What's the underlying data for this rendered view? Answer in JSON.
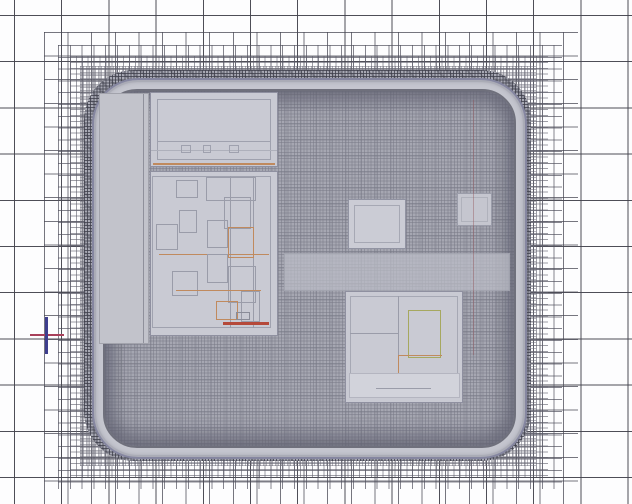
{
  "view": {
    "description": "Adaptive mesh view of chip package",
    "canvas": {
      "width": 632,
      "height": 504
    },
    "background": "#fdfdfe"
  },
  "colors": {
    "coarse_grid_line": "#44444e",
    "package_band": "#c5c6cf",
    "package_edge": "#8586a0",
    "die_mesh_base": "#a6a7b2",
    "block_fill": "#c9cad3",
    "block_border": "#8f90a0",
    "accent_orange": "#c08a5e",
    "accent_red": "#b5493a",
    "accent_green": "#a6a85f",
    "marker_red": "#a8405a",
    "marker_navy": "#3e3e8e"
  },
  "grid": {
    "coarse_cell_px": 47,
    "zones": [
      {
        "name": "refine-24px",
        "x": 44,
        "y": 32,
        "w": 534,
        "h": 472,
        "cell": 23.6,
        "line": "rgba(72,72,84,0.75)"
      },
      {
        "name": "refine-12px",
        "x": 58,
        "y": 45,
        "w": 504,
        "h": 444,
        "cell": 11.8,
        "line": "rgba(82,82,95,0.7)"
      },
      {
        "name": "refine-6px",
        "x": 70,
        "y": 56,
        "w": 478,
        "h": 421,
        "cell": 5.9,
        "line": "rgba(94,94,107,0.6)"
      },
      {
        "name": "refine-3px",
        "x": 80,
        "y": 66,
        "w": 456,
        "h": 400,
        "cell": 3.0,
        "line": "rgba(110,110,122,0.5)"
      }
    ]
  },
  "package": {
    "halo": {
      "x": 84,
      "y": 70,
      "w": 447,
      "h": 391
    },
    "body": {
      "x": 92,
      "y": 78,
      "w": 431,
      "h": 377
    },
    "interior": {
      "x": 103,
      "y": 89,
      "w": 409,
      "h": 355
    }
  },
  "blocks": [
    {
      "id": "left-margin-strip",
      "x": 99,
      "y": 93,
      "w": 50,
      "h": 251,
      "fill": "#c2c3cb",
      "border": "rgba(140,141,152,0.6)",
      "textured": true,
      "inner": [
        {
          "x": 43,
          "y": 0,
          "w": 1,
          "h": 249,
          "fill": "#8f909b"
        }
      ]
    },
    {
      "id": "top-block",
      "x": 150,
      "y": 92,
      "w": 128,
      "h": 75,
      "fill": "#c9cad3",
      "border": "#8f90a0",
      "textured": true,
      "inner": [
        {
          "x": 6,
          "y": 6,
          "w": 114,
          "h": 61,
          "stroke": "#9fa1ae"
        },
        {
          "x": 6,
          "y": 48,
          "w": 114,
          "h": 1,
          "fill": "#9fa1ae"
        },
        {
          "x": 0,
          "y": 57,
          "w": 126,
          "h": 1,
          "fill": "#aeb0bb"
        },
        {
          "x": 30,
          "y": 52,
          "w": 10,
          "h": 8,
          "stroke": "#9fa1ae"
        },
        {
          "x": 52,
          "y": 52,
          "w": 8,
          "h": 8,
          "stroke": "#9fa1ae"
        },
        {
          "x": 78,
          "y": 52,
          "w": 10,
          "h": 8,
          "stroke": "#9fa1ae"
        },
        {
          "x": 2,
          "y": 70,
          "w": 122,
          "h": 2,
          "fill": "#c08a5e"
        }
      ]
    },
    {
      "id": "left-tall-block",
      "x": 150,
      "y": 171,
      "w": 128,
      "h": 165,
      "fill": "#c9cad3",
      "border": "#8f90a0",
      "textured": true,
      "inner": [
        {
          "x": 1,
          "y": 4,
          "w": 119,
          "h": 152,
          "stroke": "#a0a2af"
        },
        {
          "x": 79,
          "y": 4,
          "w": 1,
          "h": 152,
          "fill": "#9a9ca9"
        },
        {
          "x": 102,
          "y": 4,
          "w": 1,
          "h": 152,
          "fill": "#9a9ca9"
        },
        {
          "x": 25,
          "y": 8,
          "w": 22,
          "h": 18,
          "stroke": "#9a9ca9"
        },
        {
          "x": 55,
          "y": 5,
          "w": 50,
          "h": 24,
          "stroke": "#9a9ca9"
        },
        {
          "x": 73,
          "y": 25,
          "w": 27,
          "h": 32,
          "stroke": "#9a9ca9"
        },
        {
          "x": 28,
          "y": 38,
          "w": 18,
          "h": 23,
          "stroke": "#9a9ca9"
        },
        {
          "x": 5,
          "y": 52,
          "w": 22,
          "h": 26,
          "stroke": "#9a9ca9"
        },
        {
          "x": 56,
          "y": 48,
          "w": 21,
          "h": 28,
          "stroke": "#9a9ca9"
        },
        {
          "x": 77,
          "y": 55,
          "w": 26,
          "h": 31,
          "stroke": "#c08a5e"
        },
        {
          "x": 8,
          "y": 82,
          "w": 110,
          "h": 1,
          "fill": "#c08a5e"
        },
        {
          "x": 56,
          "y": 82,
          "w": 21,
          "h": 29,
          "stroke": "#9a9ca9"
        },
        {
          "x": 21,
          "y": 99,
          "w": 26,
          "h": 25,
          "stroke": "#9a9ca9"
        },
        {
          "x": 77,
          "y": 94,
          "w": 28,
          "h": 37,
          "stroke": "#9a9ca9"
        },
        {
          "x": 25,
          "y": 118,
          "w": 85,
          "h": 1,
          "fill": "#c08a5e"
        },
        {
          "x": 65,
          "y": 129,
          "w": 22,
          "h": 19,
          "stroke": "#c08a5e"
        },
        {
          "x": 90,
          "y": 119,
          "w": 19,
          "h": 31,
          "stroke": "#9a9ca9"
        },
        {
          "x": 85,
          "y": 140,
          "w": 14,
          "h": 8,
          "stroke": "#8a8c98"
        },
        {
          "x": 72,
          "y": 150,
          "w": 46,
          "h": 3,
          "fill": "#b5493a"
        }
      ]
    },
    {
      "id": "center-square-block",
      "x": 348,
      "y": 199,
      "w": 58,
      "h": 50,
      "fill": "#cbccd5",
      "border": "#9193a2",
      "textured": false,
      "inner": [
        {
          "x": 5,
          "y": 5,
          "w": 46,
          "h": 38,
          "stroke": "#a6a8b4"
        }
      ]
    },
    {
      "id": "right-small-block",
      "x": 457,
      "y": 193,
      "w": 35,
      "h": 33,
      "fill": "#c5c6cf",
      "border": "#9b9daa",
      "textured": false,
      "inner": [
        {
          "x": 3,
          "y": 3,
          "w": 27,
          "h": 25,
          "stroke": "rgba(170,172,182,0.8)"
        }
      ]
    },
    {
      "id": "mid-light-band",
      "x": 284,
      "y": 253,
      "w": 226,
      "h": 38,
      "fill": "rgba(187,188,198,0.72)",
      "border": "rgba(150,152,163,0.5)",
      "textured": true,
      "inner": []
    },
    {
      "id": "bottom-right-block",
      "x": 345,
      "y": 291,
      "w": 118,
      "h": 112,
      "fill": "#c9cad3",
      "border": "#8f90a0",
      "textured": true,
      "inner": [
        {
          "x": 4,
          "y": 4,
          "w": 108,
          "h": 102,
          "stroke": "#a6a8b4"
        },
        {
          "x": 52,
          "y": 4,
          "w": 1,
          "h": 80,
          "fill": "#9a9ca9"
        },
        {
          "x": 62,
          "y": 18,
          "w": 33,
          "h": 48,
          "stroke": "#a6a85f"
        },
        {
          "x": 4,
          "y": 41,
          "w": 49,
          "h": 1,
          "fill": "#9a9ca9"
        },
        {
          "x": 52,
          "y": 63,
          "w": 44,
          "h": 1,
          "fill": "#c08a5e"
        },
        {
          "x": 52,
          "y": 63,
          "w": 1,
          "h": 21,
          "fill": "#c08a5e"
        },
        {
          "x": 3,
          "y": 81,
          "w": 111,
          "h": 25,
          "fill": "#d2d3db",
          "stroke": "#b4b5c0"
        },
        {
          "x": 30,
          "y": 96,
          "w": 55,
          "h": 1,
          "fill": "#9a9ca9"
        }
      ]
    },
    {
      "id": "faint-red-trace",
      "x": 473,
      "y": 100,
      "w": 1,
      "h": 255,
      "fill": "rgba(150,90,95,0.45)",
      "border": "none",
      "textured": false,
      "inner": []
    }
  ],
  "origin_marker": {
    "cx": 46,
    "cy": 335,
    "x_axis": {
      "x": 30,
      "y": 334,
      "w": 34,
      "h": 2,
      "color": "#a8405a"
    },
    "y_axis": {
      "x": 45,
      "y": 317,
      "w": 3,
      "h": 37,
      "color": "#3e3e8e"
    }
  }
}
